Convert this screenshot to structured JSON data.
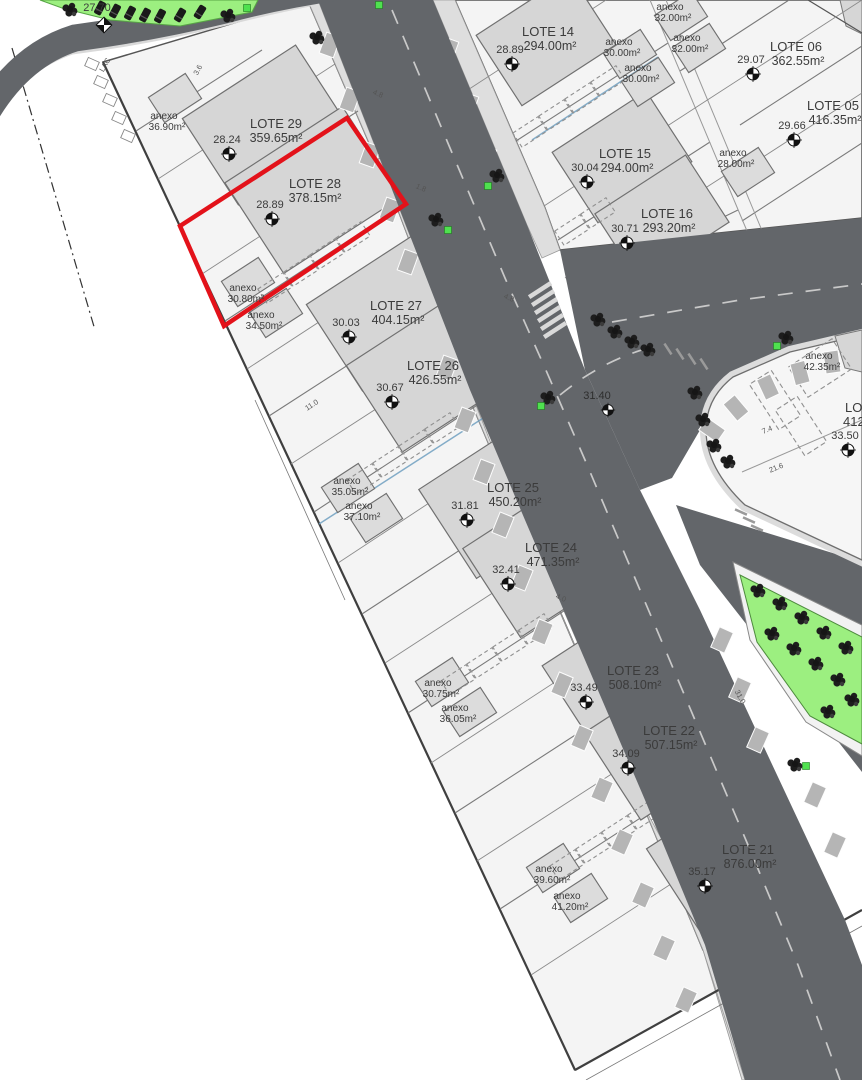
{
  "plan": {
    "type": "urbanization-site-plan",
    "selected_lot": {
      "name": "LOTE 28",
      "area": "378.15m²",
      "elevation": "28.89",
      "highlight_color": "#e3121a"
    },
    "lots": [
      {
        "name": "LOTE 29",
        "area": "359.65m²",
        "elevation": "28.24"
      },
      {
        "name": "LOTE 28",
        "area": "378.15m²",
        "elevation": "28.89"
      },
      {
        "name": "LOTE 27",
        "area": "404.15m²",
        "elevation": "30.03"
      },
      {
        "name": "LOTE 26",
        "area": "426.55m²",
        "elevation": "30.67"
      },
      {
        "name": "LOTE 25",
        "area": "450.20m²",
        "elevation": "31.81"
      },
      {
        "name": "LOTE 24",
        "area": "471.35m²",
        "elevation": "32.41"
      },
      {
        "name": "LOTE 23",
        "area": "508.10m²",
        "elevation": "33.49"
      },
      {
        "name": "LOTE 22",
        "area": "507.15m²",
        "elevation": "34.09"
      },
      {
        "name": "LOTE 21",
        "area": "876.00m²",
        "elevation": "35.17"
      },
      {
        "name": "LOTE 14",
        "area": "294.00m²",
        "elevation": "28.89"
      },
      {
        "name": "LOTE 15",
        "area": "294.00m²",
        "elevation": "30.04"
      },
      {
        "name": "LOTE 16",
        "area": "293.20m²",
        "elevation": "30.71"
      },
      {
        "name": "LOTE 06",
        "area": "362.55m²",
        "elevation": "29.07"
      },
      {
        "name": "LOTE 05",
        "area": "416.35m²",
        "elevation": "29.66"
      }
    ],
    "partial_lot": {
      "name": "LOTE",
      "area": "412"
    },
    "anexos": [
      {
        "label": "anexo",
        "area": "36.90m²"
      },
      {
        "label": "anexo",
        "area": "30.80m²"
      },
      {
        "label": "anexo",
        "area": "34.50m²"
      },
      {
        "label": "anexo",
        "area": "35.05m²"
      },
      {
        "label": "anexo",
        "area": "37.10m²"
      },
      {
        "label": "anexo",
        "area": "30.75m²"
      },
      {
        "label": "anexo",
        "area": "36.05m²"
      },
      {
        "label": "anexo",
        "area": "39.60m²"
      },
      {
        "label": "anexo",
        "area": "41.20m²"
      },
      {
        "label": "anexo",
        "area": "32.00m²"
      },
      {
        "label": "anexo",
        "area": "32.00m²"
      },
      {
        "label": "anexo",
        "area": "30.00m²"
      },
      {
        "label": "anexo",
        "area": "30.00m²"
      },
      {
        "label": "anexo",
        "area": "28.00m²"
      },
      {
        "label": "anexo",
        "area": "42.35m²"
      }
    ],
    "spot_elevations": [
      {
        "value": "27.70"
      },
      {
        "value": "31.40"
      },
      {
        "value": "33.50"
      }
    ],
    "annotations": {
      "lac": "LAC"
    },
    "dims": [
      "3.6",
      "4.8",
      "1.8",
      "4.8",
      "11.0",
      "7.4",
      "21.6",
      "4.0",
      "31.0"
    ],
    "colors": {
      "highlight": "#e3121a",
      "asphalt": "#63666a",
      "sidewalk": "#dedede",
      "parking_bay": "#b5b5b5",
      "lot_fill": "#f4f4f4",
      "footprint": "#d6d6d6",
      "green_area": "#9cef80",
      "tree": "#1d1d1d",
      "green_marker": "#4fe14f",
      "text": "#3b3b3b"
    }
  }
}
